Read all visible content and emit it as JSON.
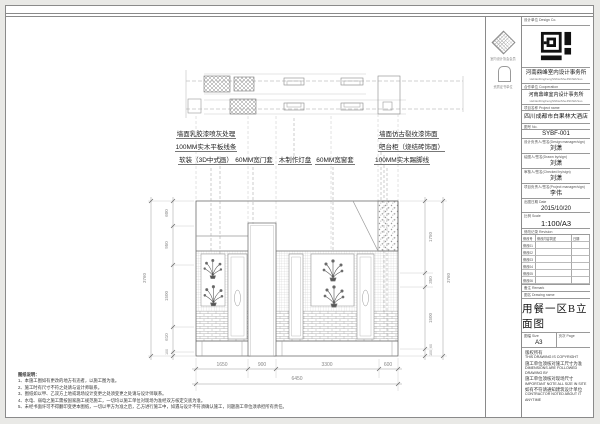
{
  "stamps": {
    "assoc_caption": "室内设计协会会员",
    "cert_caption": "资质证书单位"
  },
  "title_block": {
    "header": "设计单位 Design Co.",
    "firm_cn": "河南鼎峰室内设计事务所",
    "firm_en": "HeNanDingFengShiNeiSheJiShiWuSuo",
    "coop_label": "合作单位 Cooperation",
    "coop_cn": "河南鼎峰室内设计事务所",
    "coop_en": "HeNanDingFengShiNeiSheJiShiWuSuo",
    "project_label": "项目名称 Project name",
    "project_value": "四川成都市白果林大酒店",
    "no_label": "图号 No.",
    "no_value": "SYBF-001",
    "designer_label": "设计负责人/签名(Design manager/sign)",
    "designer_value": "刘潇",
    "drawn_label": "绘图人/签名(Drawn by/sign)",
    "drawn_value": "刘潇",
    "checker_label": "审核人/签名(Checked by/sign)",
    "checker_value": "刘潇",
    "pm_label": "项目负责人/签名(Project manager/sign)",
    "pm_value": "李伟",
    "date_label": "出图日期 Date",
    "date_value": "2015/10/20",
    "scale_label": "比例 Scale",
    "scale_value": "1:100/A3",
    "rev_label": "修改记录 Revision",
    "rev_cols": [
      "修改号",
      "修改内容简述(Description)",
      "日期(Date)"
    ],
    "rev_rows": [
      "修改01",
      "修改02",
      "修改03",
      "修改04",
      "修改05",
      "修改06"
    ],
    "rev_mark": "△",
    "remark_label": "备注 Remark",
    "name_label": "图名 Drawing name",
    "drawing_name": "用餐一区B立面图",
    "size_label": "图幅 Size",
    "size_value": "A3",
    "page_label": "页次 Page",
    "page_value": "",
    "copyright_lines": [
      "版权所有",
      "THIS DRAWING IS COPYRIGHT",
      "施工单位须核对施工尺寸为准",
      "DIMENSIONS ARE FOLLOWED DRAWING BY",
      "施工单位须核对现场尺寸",
      "IMPORTANT NOTE ALL SIZE IN SITE",
      "如有不符请通知建筑设计单位",
      "CONTRACTOR NOTED ABOUT IT ANYTIME"
    ]
  },
  "annotations": {
    "left": [
      "墙面乳胶漆喷灰处理",
      "100MM实木平板线条",
      "软装（3D中式画）"
    ],
    "middle": [
      "60MM宽门套",
      "木制作灯盘",
      "60MM宽窗套"
    ],
    "right": [
      "墙面仿古裂纹漆饰面",
      "吧台柜（烧结砖饰面）",
      "100MM实木踢脚线"
    ]
  },
  "notes": {
    "title": "图纸说明：",
    "lines": [
      "1、本施工图如有更改的地方有违者，以施工图为准。",
      "2、施工时有尺寸不符之处请与设计师联系。",
      "3、图纸如以甲、乙双方上地或现场设计变更之处须变更之处请与设计师联系。",
      "4、水电、弱电之施工需按国家施工规范施工，一切均以施工单位对现场为准经双方核定交底为准。",
      "5、未经书面许可不得翻印变更本图纸，一切以甲方为准之后，乙方进行施工中，如遇与设计不符须确认施工，问题施工单位须承担所有责任。"
    ]
  },
  "dims": {
    "bottom": [
      "1650",
      "900",
      "3300",
      "600"
    ],
    "bottom_total": "6450",
    "left": [
      "600",
      "950",
      "1500",
      "610",
      "100"
    ],
    "left_total": "3760",
    "right": [
      "1750",
      "350",
      "1500",
      "60",
      "100"
    ],
    "right_total": "3760"
  }
}
